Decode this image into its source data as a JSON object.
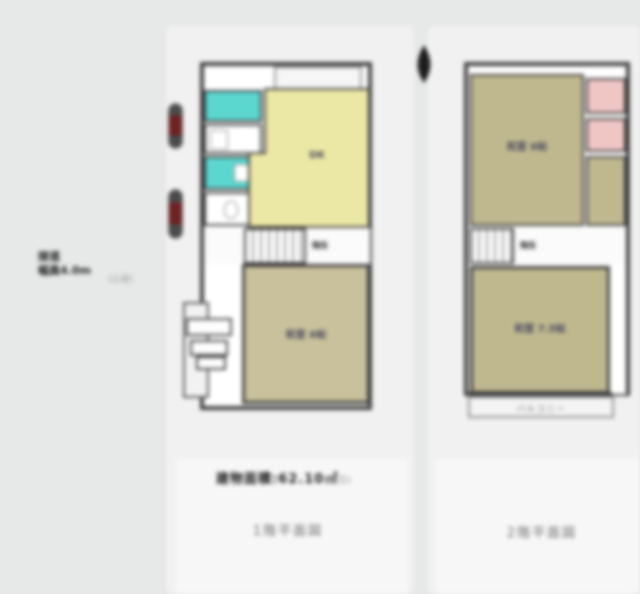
{
  "colors": {
    "background": "#e7e8e8",
    "wall": "#3f3f3f",
    "dk_yellow": "#ebe8a5",
    "bath_teal": "#5cd7d0",
    "tatami_khaki_1f": "#c9c19b",
    "tatami_khaki_2f": "#bfb88f",
    "closet_pink": "#f0c6c5",
    "marker_red": "#6e2222",
    "title_gray": "#6f6f6f"
  },
  "compass": {
    "icon": "north-arrow"
  },
  "site_note": {
    "line1": "接道",
    "line2": "幅員4.0m",
    "sub": "(公道)"
  },
  "caption": {
    "area_bold": "建物面積:62.10㎡",
    "area_note": "(壁芯)"
  },
  "floor1": {
    "title": "1階平面図",
    "rooms": {
      "dk": {
        "label": "DK"
      },
      "tatami": {
        "label": "和室 6帖"
      },
      "stairs": {
        "label": "階段"
      }
    }
  },
  "floor2": {
    "title": "2階平面図",
    "rooms": {
      "tatami_north": {
        "label": "和室 6帖"
      },
      "tatami_south": {
        "label": "和室 7.5帖"
      },
      "stairs": {
        "label": "階段"
      },
      "balcony": {
        "label": "バルコニー"
      }
    }
  }
}
